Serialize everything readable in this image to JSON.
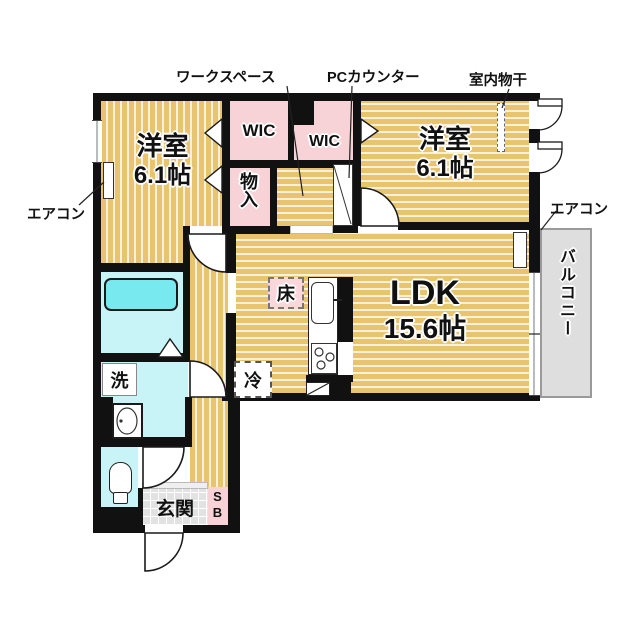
{
  "plan": {
    "rooms": {
      "bedroom_left": {
        "name": "洋室",
        "size": "6.1帖"
      },
      "bedroom_right": {
        "name": "洋室",
        "size": "6.1帖"
      },
      "ldk": {
        "name": "LDK",
        "size": "15.6帖"
      },
      "wic_left": "WIC",
      "wic_right": "WIC",
      "storage": "物入",
      "entrance": "玄関",
      "shoe_box": "SB",
      "balcony": "バルコニー"
    },
    "fixtures": {
      "floor_storage": "床",
      "refrigerator": "冷",
      "washing_machine": "洗"
    },
    "annotations": {
      "workspace": "ワークスペース",
      "pc_counter": "PCカウンター",
      "indoor_drying": "室内物干",
      "aircon_left": "エアコン",
      "aircon_right": "エアコン"
    },
    "colors": {
      "wood_floor": "#e9c46f",
      "wood_stripe": "#f8f1da",
      "closet_pink": "#f7d2d7",
      "wet_area_cyan": "#c8f4f7",
      "bathtub_cyan": "#79e9f0",
      "balcony_gray": "#dedede",
      "entrance_tile": "#e2e2e2",
      "wall": "#111111"
    }
  }
}
